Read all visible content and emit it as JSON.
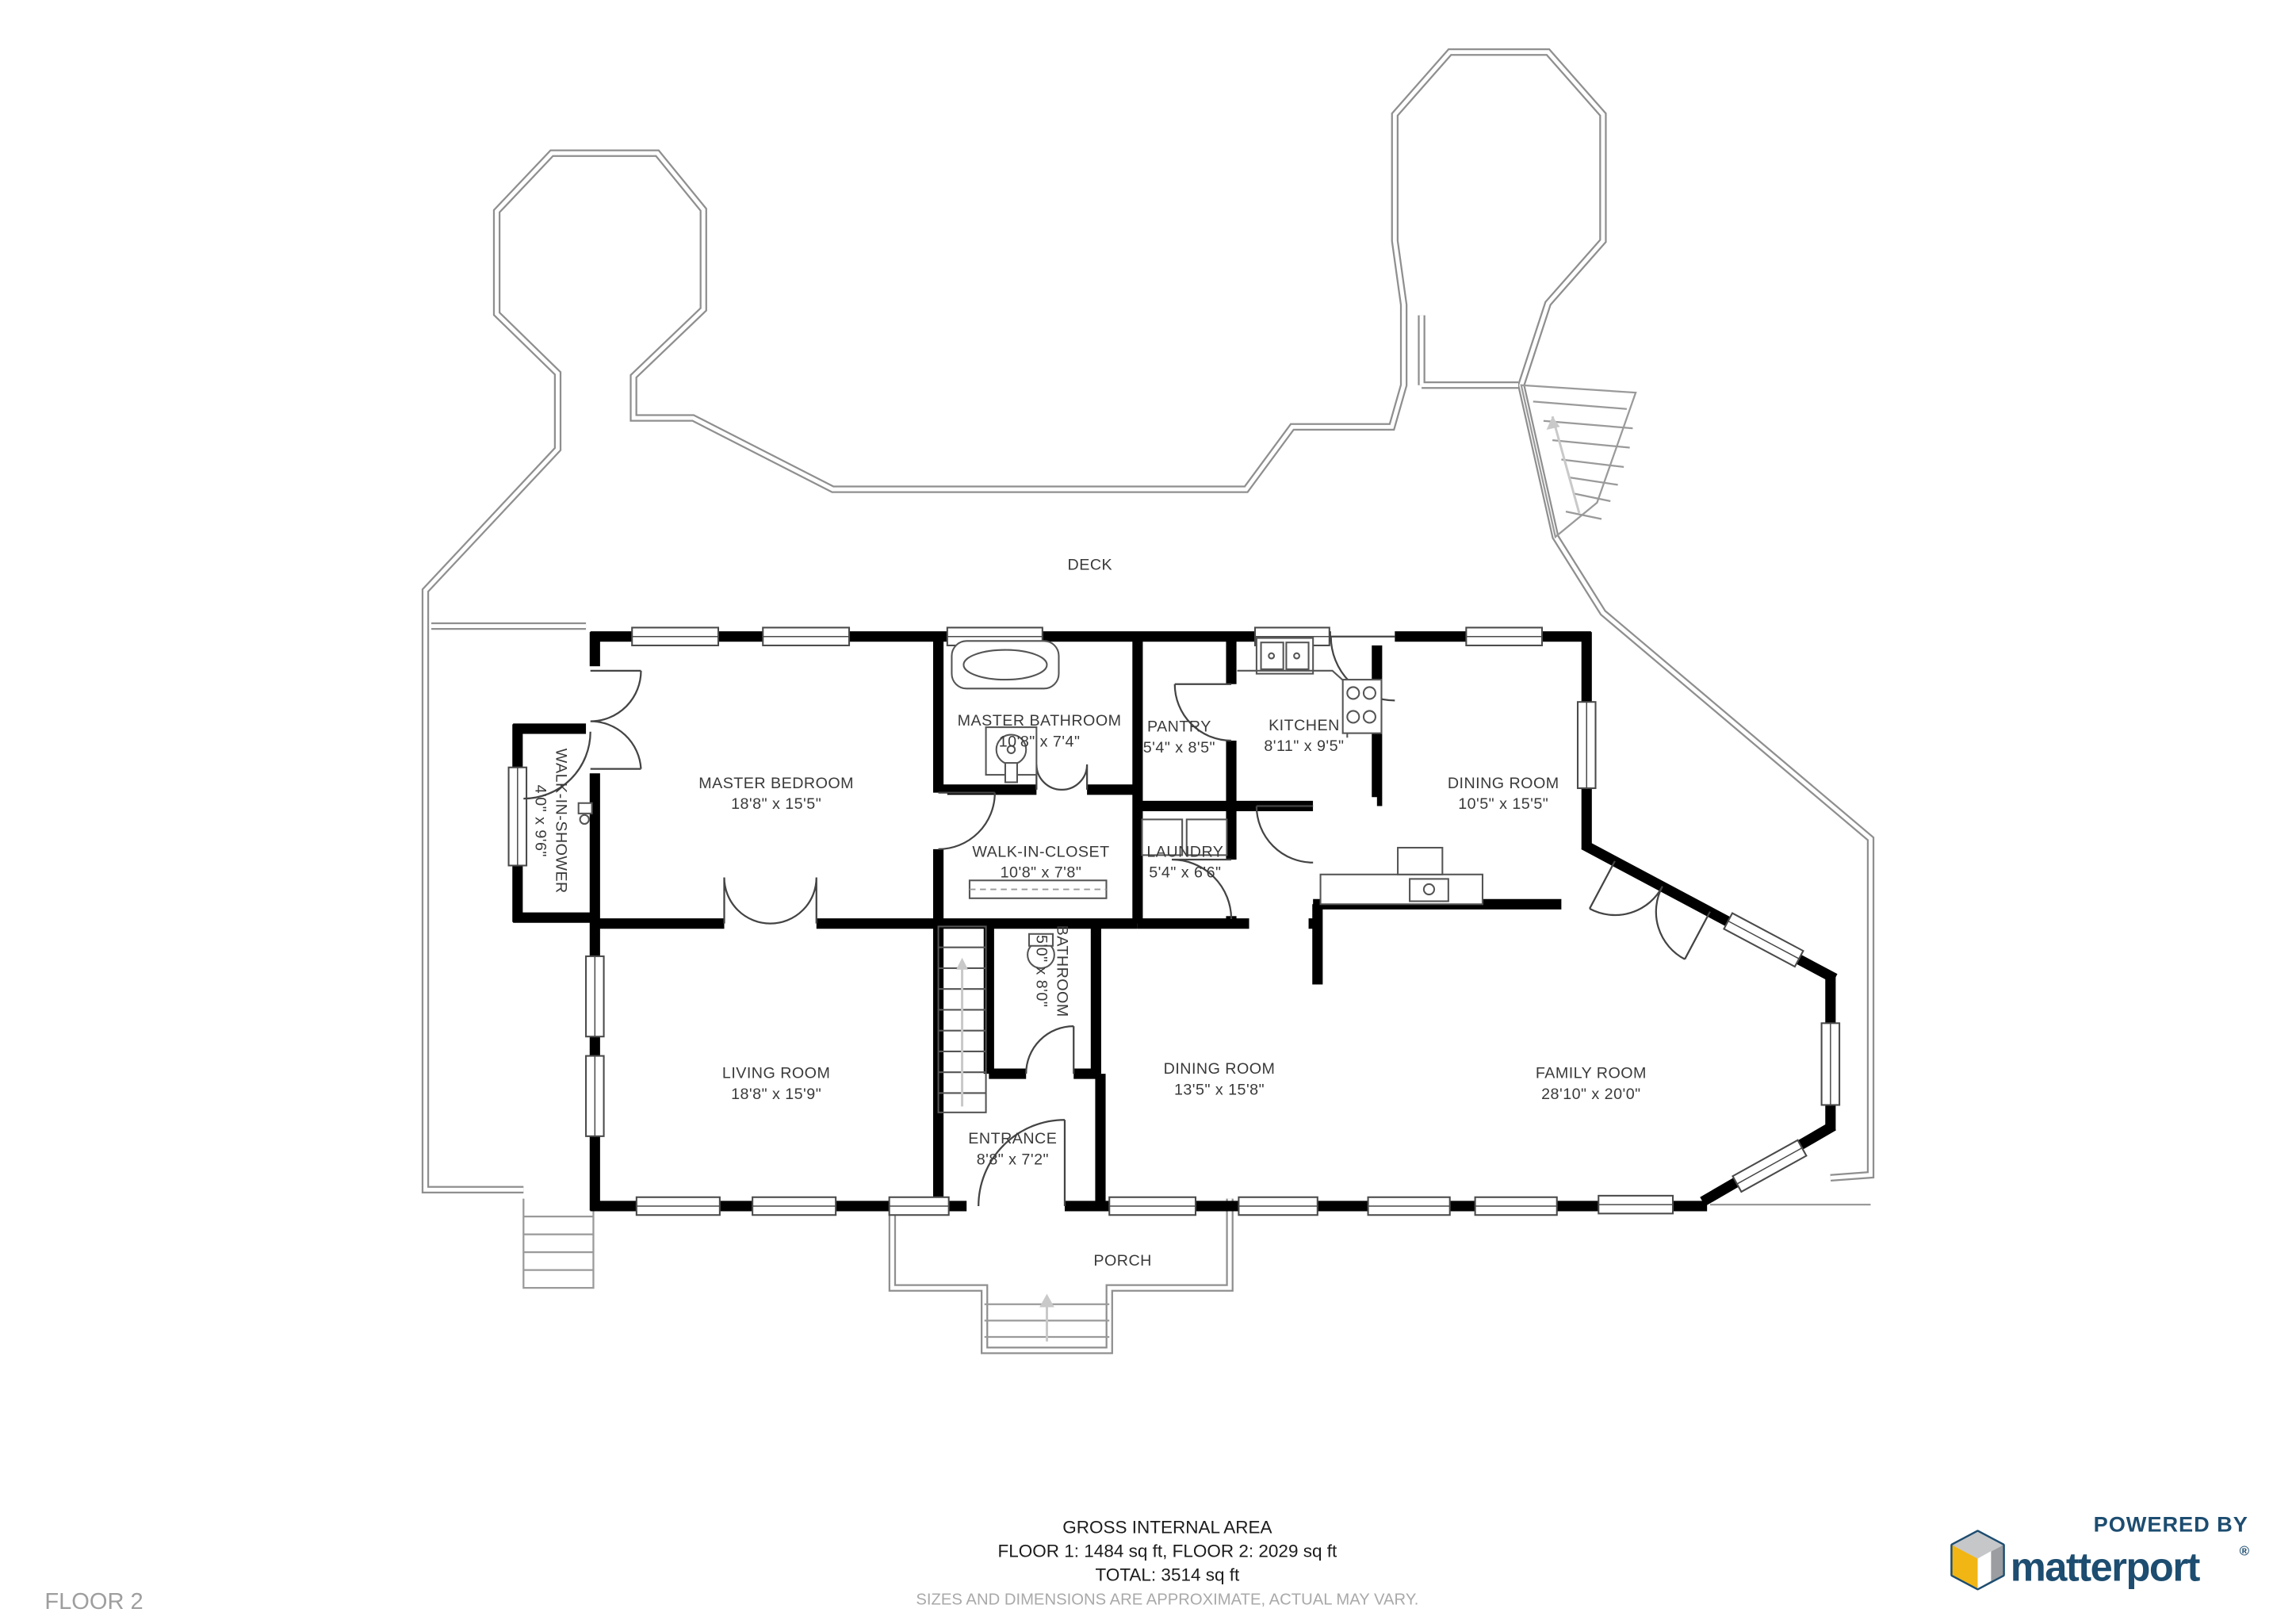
{
  "plan": {
    "floor_label": "FLOOR 2",
    "deck_label": "DECK",
    "porch_label": "PORCH",
    "rooms": [
      {
        "name": "MASTER BEDROOM",
        "dims": "18'8\" x 15'5\""
      },
      {
        "name": "MASTER BATHROOM",
        "dims": "10'8\" x 7'4\""
      },
      {
        "name": "PANTRY",
        "dims": "5'4\" x 8'5\""
      },
      {
        "name": "KITCHEN",
        "dims": "8'11\" x 9'5\""
      },
      {
        "name": "DINING ROOM",
        "dims": "10'5\" x 15'5\""
      },
      {
        "name": "WALK-IN-CLOSET",
        "dims": "10'8\" x 7'8\""
      },
      {
        "name": "LAUNDRY",
        "dims": "5'4\" x 6'6\""
      },
      {
        "name": "WALK-IN-SHOWER",
        "dims": "4'0\" x 9'6\""
      },
      {
        "name": "LIVING ROOM",
        "dims": "18'8\" x 15'9\""
      },
      {
        "name": "BATHROOM",
        "dims": "5'0\" x 8'0\""
      },
      {
        "name": "DINING ROOM",
        "dims": "13'5\" x 15'8\""
      },
      {
        "name": "FAMILY ROOM",
        "dims": "28'10\" x 20'0\""
      },
      {
        "name": "ENTRANCE",
        "dims": "8'8\" x 7'2\""
      }
    ],
    "footer": {
      "title": "GROSS INTERNAL AREA",
      "floors": "FLOOR 1: 1484 sq ft, FLOOR 2: 2029 sq ft",
      "total": "TOTAL: 3514 sq ft",
      "disclaimer": "SIZES AND DIMENSIONS ARE APPROXIMATE, ACTUAL MAY VARY."
    },
    "branding": {
      "powered_by": "POWERED BY",
      "brand": "matterport",
      "registered": "®"
    },
    "colors": {
      "wall": "#000000",
      "deck_outline": "#8f8f8f",
      "brand_navy": "#1d4d70",
      "brand_yellow": "#f1b514",
      "label": "#3a3a3a",
      "muted": "#a9a9a9"
    }
  }
}
